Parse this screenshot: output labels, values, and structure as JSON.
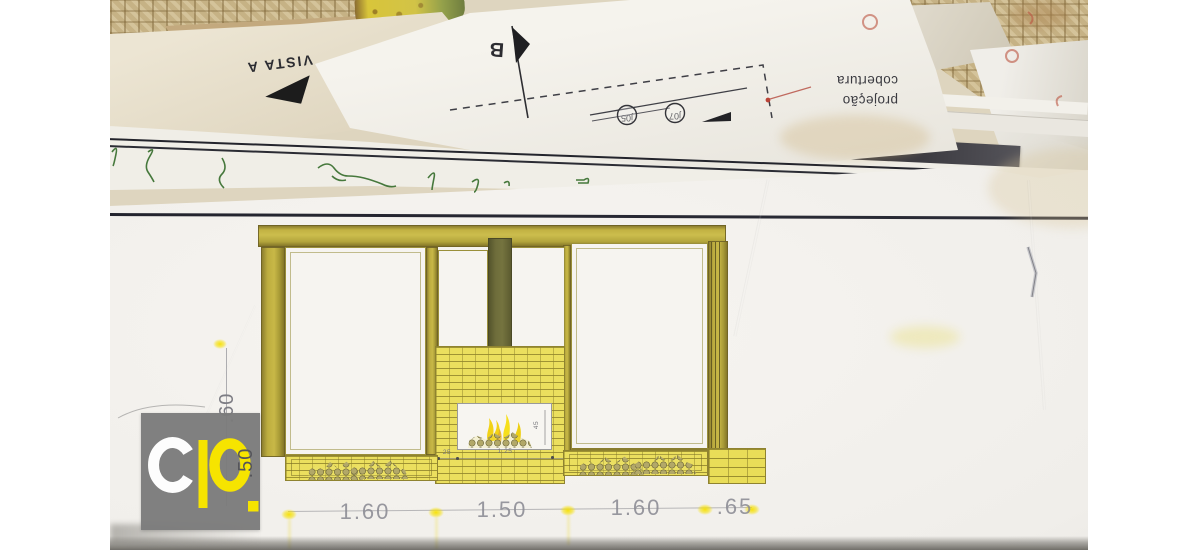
{
  "photo": {
    "vista_sheet": {
      "label": "VISTA A"
    },
    "section_sheet": {
      "marker": "B",
      "window_tags": [
        "j05",
        "j07"
      ],
      "note": {
        "line1": "projeção",
        "line2": "cobertura"
      }
    },
    "elevation": {
      "dims_bottom": [
        "1.60",
        "1.50",
        "1.60",
        ".65"
      ],
      "dims_left": [
        ".60",
        ".50"
      ],
      "firebox": {
        "offset": "25",
        "width": "1.25",
        "height": "45"
      }
    },
    "logo": {
      "text": "cp."
    },
    "colors": {
      "frame_olive": "#b9a93e",
      "brick_yellow": "#ebdf5e",
      "chimney_olive": "#6e6d3b",
      "flame_yellow": "#f2d91e",
      "highlight_yellow": "#f5e000",
      "logo_gray": "#7b7b7b",
      "logo_yellow": "#f6e400"
    }
  }
}
